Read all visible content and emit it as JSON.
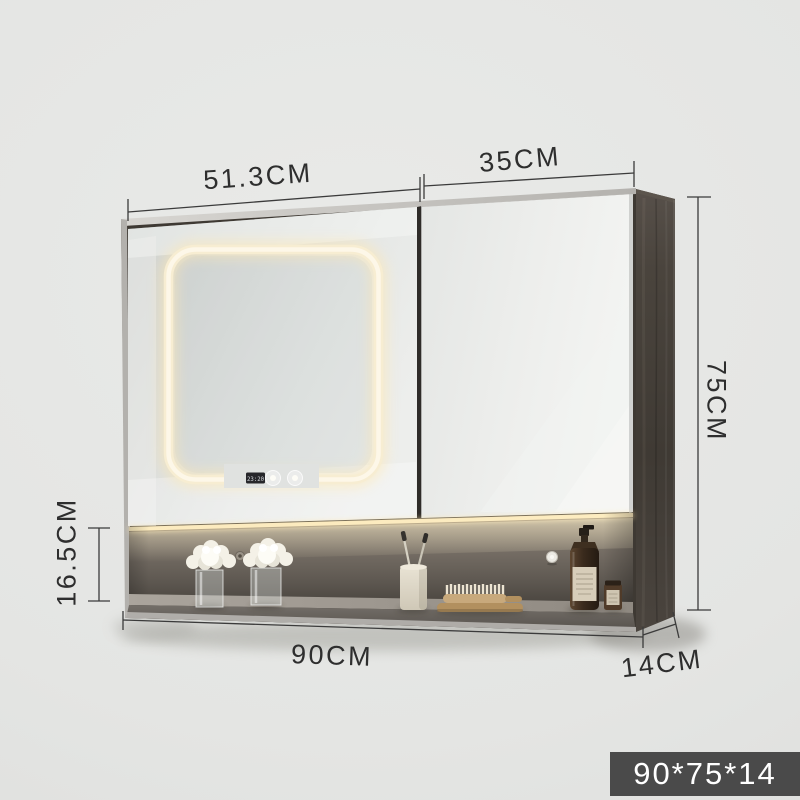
{
  "diagram": {
    "labels": {
      "left_door_width": "51.3CM",
      "right_door_width": "35CM",
      "height": "75CM",
      "shelf_height": "16.5CM",
      "total_width": "90CM",
      "depth": "14CM"
    },
    "size_badge": "90*75*14"
  },
  "cabinet": {
    "clock_time": "23:20",
    "shelf_items": [
      "flower-vase",
      "flower-vase",
      "toothbrush-cup",
      "wooden-brush-on-tray",
      "soap-dispenser-bottle",
      "cosmetic-jar"
    ]
  },
  "colors": {
    "background": "#e4e5e3",
    "badge_background": "#4a4a4a",
    "badge_text": "#ffffff",
    "dimension_line": "#3b3b3b",
    "dimension_text": "#2e2e2e",
    "led_glow": "#f7edd2",
    "cabinet_frame": "#3e3933",
    "side_panel_wood": "#46403a",
    "shelf_back_wall": "#6e6760"
  }
}
